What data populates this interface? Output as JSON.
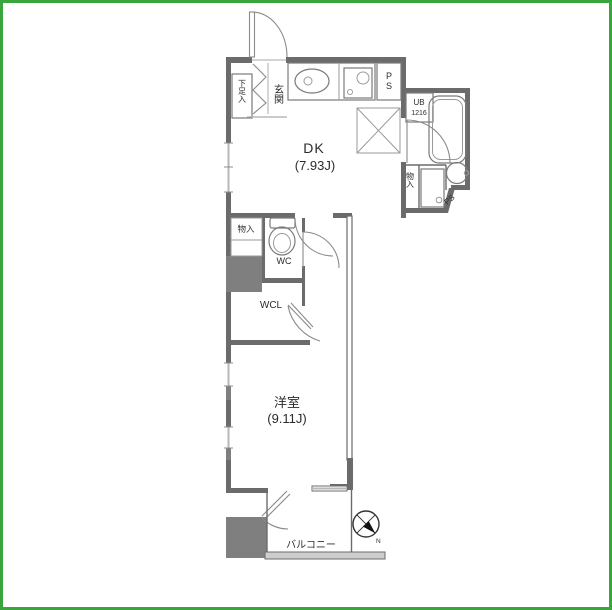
{
  "plan_title": "apartment-floor-plan",
  "colors": {
    "border_green": "#3aa53a",
    "wall_gray": "#6b6b6b",
    "column_gray": "#7f7f7f",
    "glass_gray": "#b8b8b8",
    "balcony_deck_gray": "#cdcdcd",
    "text": "#2b2b2b"
  },
  "rooms": {
    "dk": {
      "label": "DK",
      "size": "(7.93J)"
    },
    "western_room": {
      "label": "洋室",
      "size": "(9.11J)"
    },
    "balcony": {
      "label": "バルコニー"
    },
    "entrance": {
      "label": "玄関"
    },
    "shoe_storage": {
      "label": "下足入"
    },
    "wc": {
      "label": "WC"
    },
    "walk_in_closet": {
      "label": "WCL"
    },
    "unit_bath": {
      "label": "UB",
      "size": "1216"
    },
    "storage_hall": {
      "label": "物入"
    },
    "storage_washroom": {
      "label": "物入"
    },
    "pipe_space_top": {
      "label": "PS"
    },
    "pipe_space_corner": {
      "label": "PS"
    }
  },
  "compass": {
    "north_label": "N"
  },
  "fixture_icons": [
    "kitchen-sink-icon",
    "gas-stove-icon",
    "refrigerator-space-icon",
    "bathtub-icon",
    "washbasin-icon",
    "washing-machine-icon",
    "toilet-icon",
    "compass-icon"
  ]
}
